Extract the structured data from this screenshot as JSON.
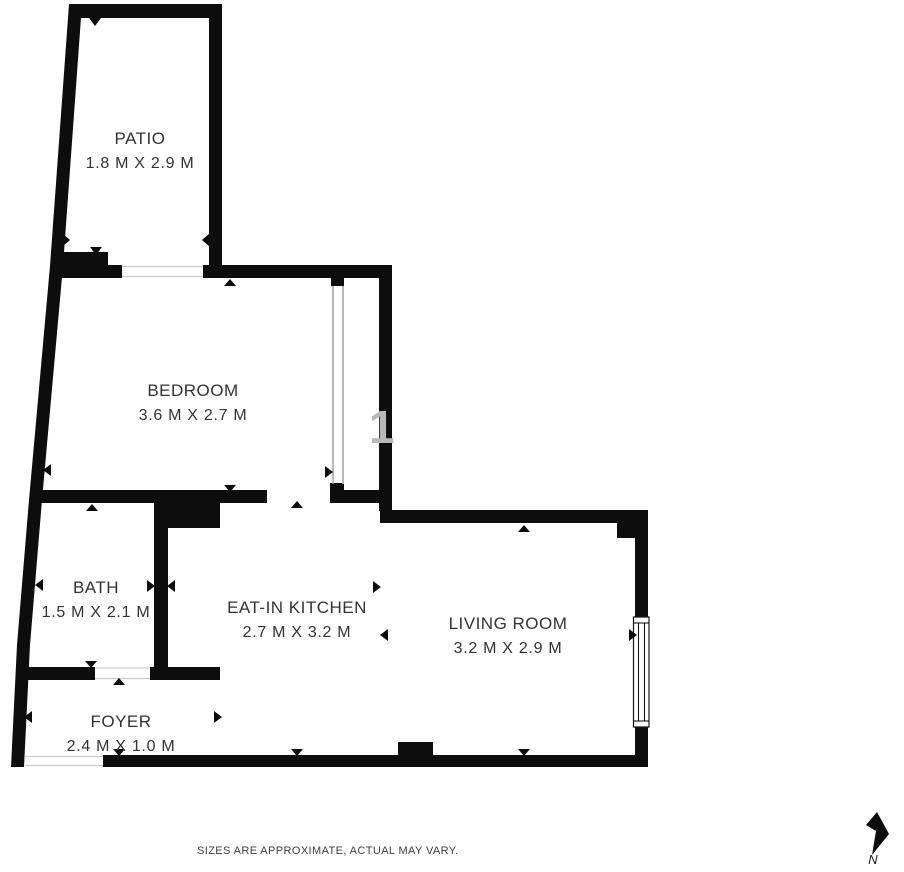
{
  "floor_plan": {
    "rooms": [
      {
        "id": "patio",
        "name": "PATIO",
        "dimensions": "1.8 M X 2.9 M"
      },
      {
        "id": "bedroom",
        "name": "BEDROOM",
        "dimensions": "3.6 M X 2.7 M"
      },
      {
        "id": "bath",
        "name": "BATH",
        "dimensions": "1.5 M X 2.1 M"
      },
      {
        "id": "kitchen",
        "name": "EAT-IN KITCHEN",
        "dimensions": "2.7 M X 3.2 M"
      },
      {
        "id": "living",
        "name": "LIVING ROOM",
        "dimensions": "3.2 M X 2.9 M"
      },
      {
        "id": "foyer",
        "name": "FOYER",
        "dimensions": "2.4 M X 1.0 M"
      }
    ],
    "disclaimer": "SIZES ARE APPROXIMATE, ACTUAL MAY VARY.",
    "compass_label": "N",
    "watermark_text": "1",
    "colors": {
      "wall": "#0d0d0d",
      "label_text": "#333333",
      "disclaimer_text": "#3d3d3d",
      "watermark": "#b8b8b8",
      "door_sill": "#c9c9c9",
      "background": "#ffffff"
    }
  }
}
